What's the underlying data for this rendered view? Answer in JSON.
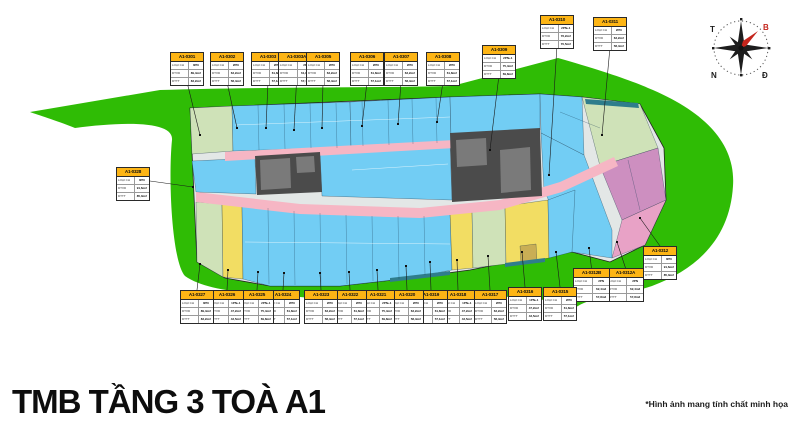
{
  "title": "TMB TẦNG 3 TOÀ A1",
  "footnote": "*Hình ảnh mang tính chất minh họa",
  "compass": {
    "west": "T",
    "north": "B",
    "south": "N",
    "east": "Đ",
    "north_color": "#c4251c"
  },
  "palette": {
    "site_green": "#2fbc05",
    "unit_blue": "#72cdf4",
    "unit_pale_green": "#cfe2b8",
    "unit_yellow": "#f2dd63",
    "unit_mauve": "#cd8fc0",
    "unit_pink": "#e8a2c6",
    "unit_khaki": "#c9ae55",
    "strip_teal": "#2f7d8c",
    "corridor_pink": "#f6b6c4",
    "core_dark": "#4b4b4b",
    "label_yellow": "#fdb515"
  },
  "label_fields": {
    "type": "LOẠI CH",
    "area1": "DTXD",
    "area2": "DTTT"
  },
  "units": [
    {
      "code": "A1-0301",
      "type": "3PN",
      "area1": "89,4m2",
      "area2": "83,2m2",
      "x": 170,
      "y": 52,
      "side": "top",
      "tx": 200,
      "ty": 135
    },
    {
      "code": "A1-0302",
      "type": "2PN",
      "area1": "63,2m2",
      "area2": "58,4m2",
      "x": 210,
      "y": 52,
      "side": "top",
      "tx": 237,
      "ty": 128
    },
    {
      "code": "A1-0303",
      "type": "2PN",
      "area1": "61,8m2",
      "area2": "57,1m2",
      "x": 251,
      "y": 52,
      "side": "top",
      "tx": 266,
      "ty": 128
    },
    {
      "code": "A1-0303A",
      "type": "2PN",
      "area1": "61,8m2",
      "area2": "57,1m2",
      "x": 278,
      "y": 52,
      "w": 37,
      "side": "top",
      "tx": 294,
      "ty": 130
    },
    {
      "code": "A1-0305",
      "type": "2PN",
      "area1": "63,2m2",
      "area2": "58,4m2",
      "x": 306,
      "y": 52,
      "side": "top",
      "tx": 322,
      "ty": 128
    },
    {
      "code": "A1-0306",
      "type": "2PN",
      "area1": "61,8m2",
      "area2": "57,1m2",
      "x": 350,
      "y": 52,
      "side": "top",
      "tx": 362,
      "ty": 126
    },
    {
      "code": "A1-0307",
      "type": "2PN",
      "area1": "63,2m2",
      "area2": "58,4m2",
      "x": 384,
      "y": 52,
      "side": "top",
      "tx": 398,
      "ty": 124
    },
    {
      "code": "A1-0308",
      "type": "2PN",
      "area1": "61,8m2",
      "area2": "57,1m2",
      "x": 426,
      "y": 52,
      "side": "top",
      "tx": 437,
      "ty": 122
    },
    {
      "code": "A1-0309",
      "type": "2PN+1",
      "area1": "75,4m2",
      "area2": "69,8m2",
      "x": 482,
      "y": 45,
      "side": "top",
      "tx": 490,
      "ty": 150
    },
    {
      "code": "A1-0310",
      "type": "2PN+1",
      "area1": "76,2m2",
      "area2": "70,5m2",
      "x": 540,
      "y": 15,
      "side": "top",
      "tx": 549,
      "ty": 175
    },
    {
      "code": "A1-0311",
      "type": "2PN",
      "area1": "63,2m2",
      "area2": "58,4m2",
      "x": 593,
      "y": 17,
      "side": "top",
      "tx": 602,
      "ty": 135
    },
    {
      "code": "A1-0312",
      "type": "3PN",
      "area1": "91,6m2",
      "area2": "85,3m2",
      "x": 643,
      "y": 246,
      "side": "bottom",
      "tx": 640,
      "ty": 218
    },
    {
      "code": "A1-0312A",
      "type": "2PN",
      "area1": "62,4m2",
      "area2": "57,8m2",
      "x": 607,
      "y": 268,
      "w": 37,
      "side": "bottom",
      "tx": 617,
      "ty": 242
    },
    {
      "code": "A1-0312B",
      "type": "2PN",
      "area1": "62,4m2",
      "area2": "57,8m2",
      "x": 573,
      "y": 268,
      "w": 37,
      "side": "bottom",
      "tx": 589,
      "ty": 248
    },
    {
      "code": "A1-0315",
      "type": "2PN",
      "area1": "61,8m2",
      "area2": "57,1m2",
      "x": 543,
      "y": 287,
      "side": "bottom",
      "tx": 556,
      "ty": 252
    },
    {
      "code": "A1-0316",
      "type": "1PN+1",
      "area1": "47,2m2",
      "area2": "43,5m2",
      "x": 508,
      "y": 287,
      "side": "bottom",
      "tx": 522,
      "ty": 252
    },
    {
      "code": "A1-0317",
      "type": "2PN",
      "area1": "63,2m2",
      "area2": "58,4m2",
      "x": 473,
      "y": 290,
      "side": "bottom",
      "tx": 488,
      "ty": 256
    },
    {
      "code": "A1-0318",
      "type": "1PN+1",
      "area1": "47,2m2",
      "area2": "43,5m2",
      "x": 441,
      "y": 290,
      "side": "bottom",
      "tx": 457,
      "ty": 260
    },
    {
      "code": "A1-0319",
      "type": "2PN",
      "area1": "61,8m2",
      "area2": "57,1m2",
      "x": 414,
      "y": 290,
      "side": "bottom",
      "tx": 430,
      "ty": 262
    },
    {
      "code": "A1-0320",
      "type": "2PN",
      "area1": "63,2m2",
      "area2": "58,4m2",
      "x": 390,
      "y": 290,
      "side": "bottom",
      "tx": 406,
      "ty": 266
    },
    {
      "code": "A1-0321",
      "type": "2PN+1",
      "area1": "75,4m2",
      "area2": "69,8m2",
      "x": 361,
      "y": 290,
      "side": "bottom",
      "tx": 377,
      "ty": 270
    },
    {
      "code": "A1-0322",
      "type": "2PN",
      "area1": "61,8m2",
      "area2": "57,1m2",
      "x": 333,
      "y": 290,
      "side": "bottom",
      "tx": 349,
      "ty": 272
    },
    {
      "code": "A1-0323",
      "type": "2PN",
      "area1": "63,2m2",
      "area2": "58,4m2",
      "x": 304,
      "y": 290,
      "side": "bottom",
      "tx": 320,
      "ty": 273
    },
    {
      "code": "A1-0324",
      "type": "2PN",
      "area1": "61,8m2",
      "area2": "57,1m2",
      "x": 266,
      "y": 290,
      "side": "bottom",
      "tx": 284,
      "ty": 273
    },
    {
      "code": "A1-0325",
      "type": "2PN+1",
      "area1": "75,4m2",
      "area2": "69,8m2",
      "x": 240,
      "y": 290,
      "side": "bottom",
      "tx": 258,
      "ty": 272
    },
    {
      "code": "A1-0326",
      "type": "1PN+1",
      "area1": "47,2m2",
      "area2": "43,5m2",
      "x": 210,
      "y": 290,
      "side": "bottom",
      "tx": 228,
      "ty": 270
    },
    {
      "code": "A1-0327",
      "type": "3PN",
      "area1": "89,4m2",
      "area2": "83,2m2",
      "x": 180,
      "y": 290,
      "side": "bottom",
      "tx": 200,
      "ty": 264
    },
    {
      "code": "A1-0328",
      "type": "3PN",
      "area1": "91,6m2",
      "area2": "85,3m2",
      "x": 116,
      "y": 167,
      "side": "right",
      "tx": 193,
      "ty": 187
    }
  ]
}
